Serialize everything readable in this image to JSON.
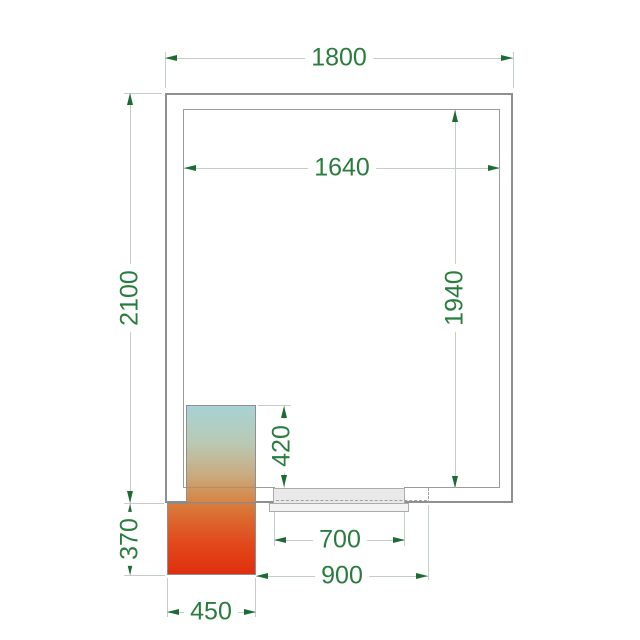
{
  "drawing": {
    "kind": "cold-room floor plan with dimensions",
    "dims": {
      "outer_width": "1800",
      "inner_width": "1640",
      "outer_depth": "2100",
      "inner_depth": "1940",
      "unit_inset_depth": "420",
      "door_clear_width": "700",
      "door_overall_width": "900",
      "unit_outer_depth": "370",
      "unit_width": "450"
    },
    "colors": {
      "dimension_text": "#2a7c3e",
      "dimension_arrow": "#1d6b33",
      "dimension_line": "#c3cfc5",
      "wall_line": "#8f8f8f",
      "door_leaf_fill": "#e9e9e9",
      "unit_gradient_top": "#a7d2d5",
      "unit_gradient_mid": "#d8823f",
      "unit_gradient_bottom": "#e02f0f"
    }
  }
}
